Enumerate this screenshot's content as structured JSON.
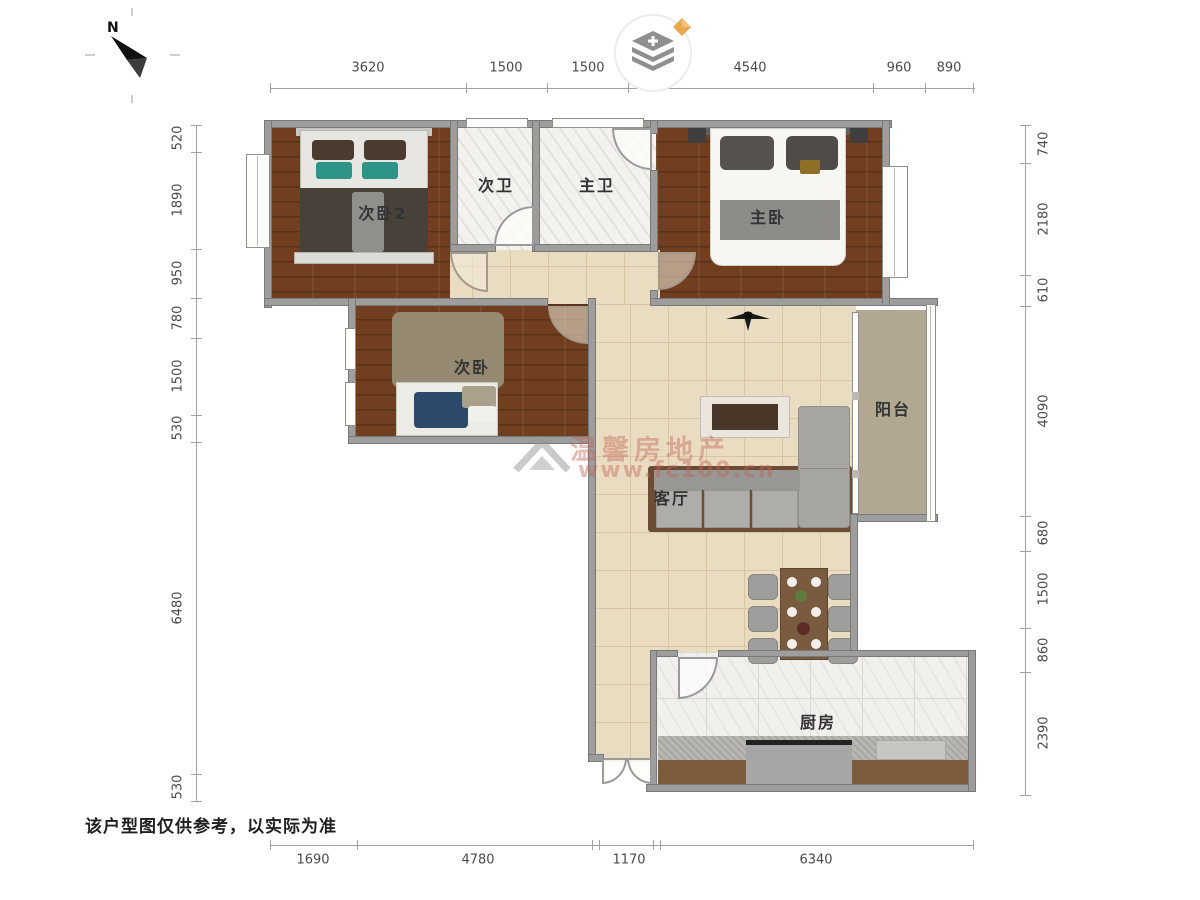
{
  "meta": {
    "disclaimer": "该户型图仅供参考，以实际为准"
  },
  "compass": {
    "label": "N"
  },
  "watermark": {
    "brand": "温馨房地产",
    "url": "www.fc100.cn"
  },
  "rooms": {
    "bedroom2": "次卧2",
    "bath2": "次卫",
    "bath_master": "主卫",
    "bedroom_master": "主卧",
    "bedroom3": "次卧",
    "living": "客厅",
    "balcony": "阳台",
    "kitchen": "厨房"
  },
  "dimensions": {
    "top": [
      "3620",
      "1500",
      "1500",
      "4540",
      "960",
      "890"
    ],
    "left": [
      "520",
      "1890",
      "950",
      "780",
      "1500",
      "530",
      "6480",
      "530"
    ],
    "right": [
      "740",
      "2180",
      "610",
      "4090",
      "680",
      "1500",
      "860",
      "2390"
    ],
    "bottom": [
      "1690",
      "4780",
      "1170",
      "6340"
    ]
  },
  "colors": {
    "wood_floor": "#713f20",
    "tile_beige": "#eadcc0",
    "balcony_tile": "#b2a892",
    "wall_gray": "#9d9d9d",
    "teal_pillow": "#2f9488",
    "logo_orange": "#eaa74e",
    "watermark_red": "rgba(193,98,86,0.42)"
  }
}
